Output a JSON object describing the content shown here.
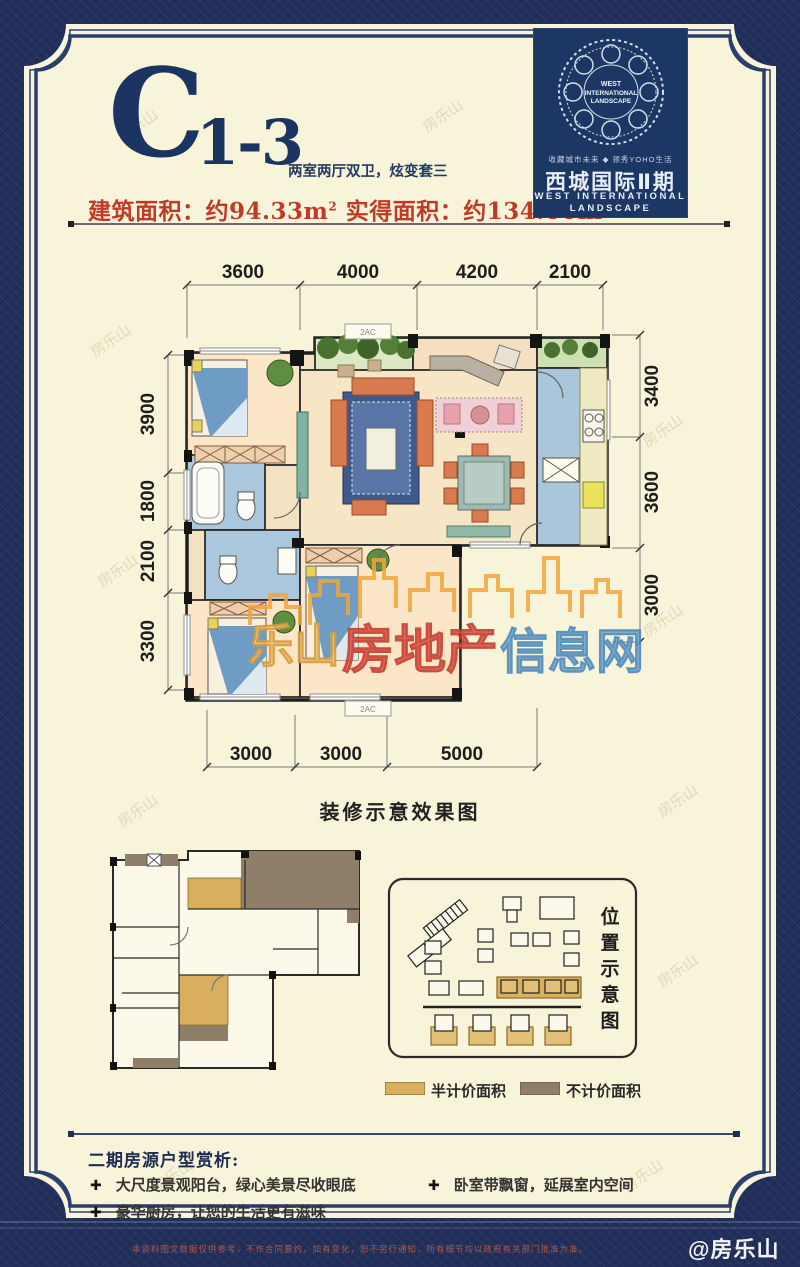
{
  "header": {
    "unit_main": "C",
    "unit_sub": "1-3",
    "tagline": "两室两厅双卫，炫变套三",
    "area1_label": "建筑面积：",
    "area1_value": "约94.33m",
    "area1_sup": "2",
    "area2_label": " 实得面积：",
    "area2_value": "约134.00m",
    "area2_sup": "2"
  },
  "logo": {
    "medallion_l1": "WEST",
    "medallion_l2": "INTERNATIONAL",
    "medallion_l3": "LANDSCAPE",
    "top_line": "收藏城市未来 ◆ 领秀YOHO生活",
    "name_cn": "西城国际Ⅱ期",
    "en_line1": "WEST INTERNATIONAL",
    "en_line2": "LANDSCAPE",
    "bg_color": "#1c3763"
  },
  "plan": {
    "dims": {
      "top": [
        "3600",
        "4000",
        "4200",
        "2100"
      ],
      "left": [
        "3900",
        "1800",
        "2100",
        "3300"
      ],
      "right": [
        "3400",
        "3600",
        "3000"
      ],
      "bottom": [
        "3000",
        "3000",
        "5000"
      ]
    },
    "ac_label": "2AC",
    "caption": "装修示意效果图"
  },
  "watermark": {
    "part1": "乐山",
    "part2": "房地产",
    "part3": "信息网",
    "faint_text": "房乐山"
  },
  "location": {
    "title_chars": [
      "位",
      "置",
      "示",
      "意",
      "图"
    ],
    "legend": [
      {
        "label": "半计价面积",
        "color": "#d9af5e"
      },
      {
        "label": "不计价面积",
        "color": "#8f7e69"
      }
    ]
  },
  "analysis": {
    "heading": "二期房源户型赏析:",
    "bullet_mark": "✚",
    "bullets": [
      "大尺度景观阳台，绿心美景尽收眼底",
      "豪华厨房，让您的生活更有滋味",
      "卧室带飘窗，延展室内空间"
    ]
  },
  "footer": {
    "disclaimer": "本资料图文数据仅供参考，不作合同要约，如有变化，恕不另行通知，所有细节均以政府有关部门批准为准。",
    "credit": "@房乐山"
  },
  "colors": {
    "frame_navy": "#222f5b",
    "paper_cream": "#f8f4da",
    "accent_red": "#c13a28",
    "title_navy": "#1c3462",
    "half_price_gold": "#d9af5e",
    "no_price_taupe": "#8f7e69"
  }
}
